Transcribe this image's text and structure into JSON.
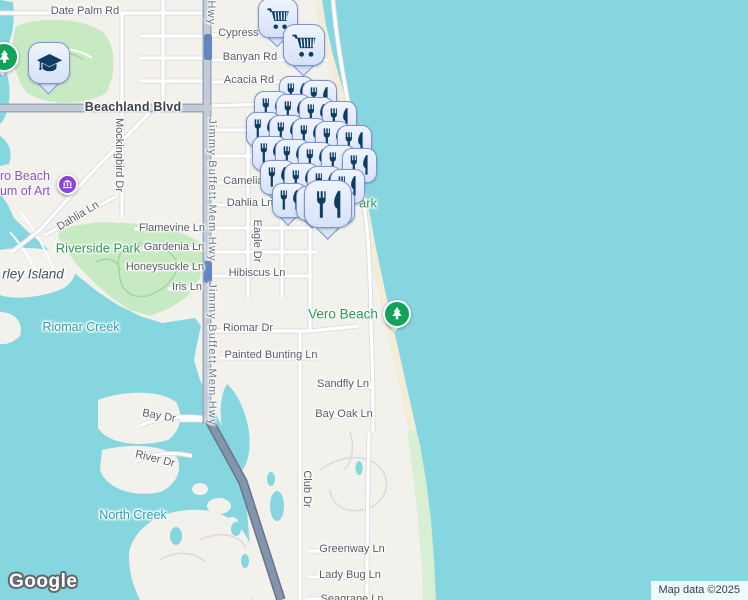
{
  "map": {
    "provider": "Google",
    "attribution": "Map data ©2025",
    "colors": {
      "water": "#86d6e0",
      "land": "#f2f1ec",
      "park_fill": "#c7eac3",
      "sand": "#f2ecd8",
      "dune": "#d8efd4",
      "road_major": "#c2cbd7",
      "bridge": "#8494aa",
      "route_shield": "#6484c2",
      "marker_fill": "#dfe8fb",
      "marker_border": "#7e93cc",
      "marker_glyph": "#0e3d63",
      "park_pin": "#12a35a",
      "museum_pin": "#8e44d8",
      "label_street": "#595d63",
      "label_park": "#2c9a52",
      "label_water": "#2aa0b2"
    },
    "museum": {
      "line1": "Vero Beach",
      "line2": "Museum of Art"
    },
    "road_labels": [
      {
        "text": "Date Palm Rd",
        "x": 85,
        "y": 11
      },
      {
        "text": "Cypress Rd",
        "x": 247,
        "y": 33
      },
      {
        "text": "Banyan Rd",
        "x": 250,
        "y": 57
      },
      {
        "text": "Acacia Rd",
        "x": 249,
        "y": 80
      },
      {
        "text": "Beachland Blvd",
        "x": 133,
        "y": 107,
        "cls": "major"
      },
      {
        "text": "Camelia Ln",
        "x": 251,
        "y": 181
      },
      {
        "text": "Dahlia Ln",
        "x": 250,
        "y": 203
      },
      {
        "text": "Dahlia Ln",
        "x": 78,
        "y": 216,
        "rot": -31
      },
      {
        "text": "Flamevine Ln",
        "x": 172,
        "y": 228
      },
      {
        "text": "Gardenia Ln",
        "x": 174,
        "y": 247
      },
      {
        "text": "Honeysuckle Ln",
        "x": 165,
        "y": 267
      },
      {
        "text": "Iris Ln",
        "x": 187,
        "y": 287
      },
      {
        "text": "Hibiscus Ln",
        "x": 257,
        "y": 273
      },
      {
        "text": "Riomar Dr",
        "x": 248,
        "y": 328
      },
      {
        "text": "Painted Bunting Ln",
        "x": 271,
        "y": 355
      },
      {
        "text": "Sandfly Ln",
        "x": 343,
        "y": 384
      },
      {
        "text": "Bay Oak Ln",
        "x": 344,
        "y": 414
      },
      {
        "text": "Bay Dr",
        "x": 159,
        "y": 416,
        "rot": 10
      },
      {
        "text": "River Dr",
        "x": 155,
        "y": 459,
        "rot": 14
      },
      {
        "text": "Greenway Ln",
        "x": 352,
        "y": 549
      },
      {
        "text": "Lady Bug Ln",
        "x": 350,
        "y": 575
      },
      {
        "text": "Seagrape Ln",
        "x": 352,
        "y": 599
      },
      {
        "text": "Mockingbird Dr",
        "x": 119,
        "y": 155,
        "rot": 90
      },
      {
        "text": "Hwy",
        "x": 211,
        "y": 13,
        "rot": 90,
        "cls": "hwy"
      },
      {
        "text": "Jimmy Buffett Mem Hwy",
        "x": 212,
        "y": 190,
        "rot": 90,
        "cls": "hwy"
      },
      {
        "text": "Jimmy Buffett Mem Hwy",
        "x": 212,
        "y": 354,
        "rot": 90,
        "cls": "hwy"
      },
      {
        "text": "Eagle Dr",
        "x": 256,
        "y": 143,
        "rot": 90
      },
      {
        "text": "Eagle Dr",
        "x": 257,
        "y": 241,
        "rot": 90
      },
      {
        "text": "Club Dr",
        "x": 307,
        "y": 489,
        "rot": 90
      }
    ],
    "place_labels": [
      {
        "text": "Riverside Park",
        "x": 98,
        "y": 248,
        "cls": "park"
      },
      {
        "text": "Vero Beach",
        "x": 343,
        "y": 314,
        "cls": "park park-big"
      },
      {
        "text": "ark",
        "x": 368,
        "y": 203,
        "cls": "park"
      },
      {
        "text": "Riomar Creek",
        "x": 81,
        "y": 327,
        "cls": "water-lbl"
      },
      {
        "text": "North Creek",
        "x": 133,
        "y": 515,
        "cls": "water-lbl"
      },
      {
        "text": "rley Island",
        "x": 33,
        "y": 274,
        "cls": "island"
      }
    ],
    "markers": [
      {
        "t": "school",
        "x": 48,
        "y": 62,
        "s": 40
      },
      {
        "t": "cart",
        "x": 277,
        "y": 17,
        "s": 38
      },
      {
        "t": "cart",
        "x": 303,
        "y": 44,
        "s": 40
      },
      {
        "t": "r",
        "x": 295,
        "y": 92
      },
      {
        "t": "r",
        "x": 318,
        "y": 96
      },
      {
        "t": "r",
        "x": 270,
        "y": 107
      },
      {
        "t": "r",
        "x": 292,
        "y": 110
      },
      {
        "t": "r",
        "x": 315,
        "y": 113
      },
      {
        "t": "r",
        "x": 338,
        "y": 117
      },
      {
        "t": "r",
        "x": 262,
        "y": 128
      },
      {
        "t": "r",
        "x": 285,
        "y": 131
      },
      {
        "t": "r",
        "x": 308,
        "y": 134
      },
      {
        "t": "r",
        "x": 331,
        "y": 137
      },
      {
        "t": "r",
        "x": 353,
        "y": 141
      },
      {
        "t": "r",
        "x": 268,
        "y": 152
      },
      {
        "t": "r",
        "x": 291,
        "y": 155
      },
      {
        "t": "r",
        "x": 314,
        "y": 158
      },
      {
        "t": "r",
        "x": 337,
        "y": 161
      },
      {
        "t": "r",
        "x": 358,
        "y": 164
      },
      {
        "t": "r",
        "x": 276,
        "y": 176
      },
      {
        "t": "r",
        "x": 300,
        "y": 179
      },
      {
        "t": "r",
        "x": 323,
        "y": 182
      },
      {
        "t": "r",
        "x": 346,
        "y": 185
      },
      {
        "t": "r",
        "x": 288,
        "y": 199
      },
      {
        "t": "r",
        "x": 312,
        "y": 202
      },
      {
        "t": "r",
        "x": 336,
        "y": 205
      },
      {
        "t": "r",
        "x": 327,
        "y": 203,
        "s": 46
      },
      {
        "t": "tree",
        "x": 2,
        "y": 55,
        "s": 26
      },
      {
        "t": "museum",
        "x": 65,
        "y": 182,
        "s": 17
      },
      {
        "t": "tree",
        "x": 395,
        "y": 312,
        "s": 24
      }
    ]
  }
}
